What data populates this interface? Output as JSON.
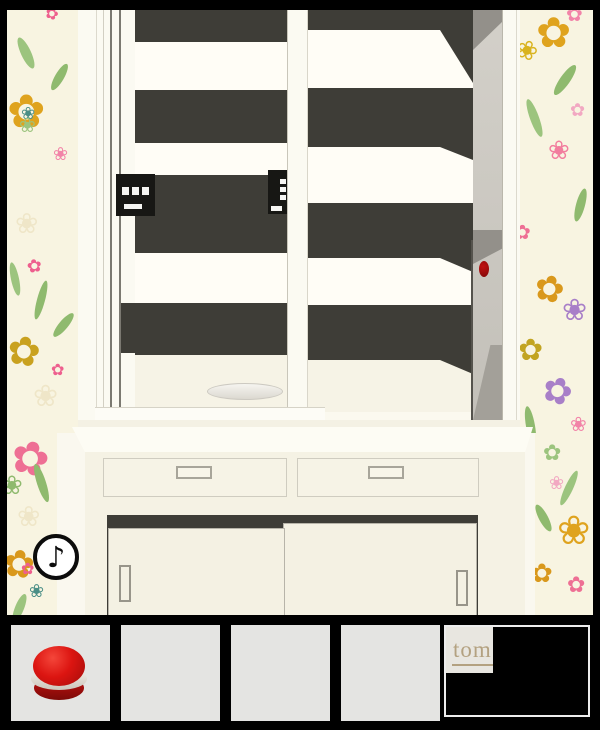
{
  "hud": {
    "music_button": {
      "icon": "music-note-icon",
      "glyph": "♪"
    }
  },
  "inventory": {
    "slots": [
      {
        "name": "slot-1",
        "item": "red-macaron"
      },
      {
        "name": "slot-2",
        "item": null
      },
      {
        "name": "slot-3",
        "item": null
      },
      {
        "name": "slot-4",
        "item": null
      },
      {
        "name": "slot-5",
        "item": "tomatea-logo",
        "label": "tom"
      }
    ]
  },
  "scene": {
    "shelf_items": [
      {
        "name": "black-box-front",
        "marks": "three-white-squares-and-bar"
      },
      {
        "name": "black-box-side",
        "marks": "three-white-squares-and-bar"
      }
    ],
    "red_button_on_side_panel": true,
    "plate_on_shelf": true,
    "drawers": 2,
    "sliding_doors": 2
  },
  "colors": {
    "frame_black": "#000000",
    "wall": "#faf8ef",
    "wallpaper_bg": "#f8f4e1",
    "cabinet_white": "#fbfaf2",
    "cabinet_cream": "#f5f2e4",
    "interior_dark": "#3e3d37",
    "side_panel": "#cbc8c1",
    "red_button": "#9c0c0c",
    "macaron_red": "#d91410",
    "macaron_cream": "#e9e4dc",
    "slot_gray": "#e4e4e2",
    "tom_text": "#b3a180"
  },
  "decor": {
    "panels": [
      {
        "container": "wp-left",
        "flowers": [
          {
            "x": 38,
            "y": -4,
            "s": 16,
            "c": "#ee5f8e",
            "g": "✿",
            "r": 20
          },
          {
            "x": 0,
            "y": 78,
            "s": 46,
            "c": "#dfa31e",
            "g": "✿",
            "r": 0
          },
          {
            "x": 14,
            "y": 96,
            "s": 17,
            "c": "#4a8e86",
            "g": "❀",
            "r": 0
          },
          {
            "x": 46,
            "y": 136,
            "s": 18,
            "c": "#f283a8",
            "g": "❀",
            "r": 0
          },
          {
            "x": 8,
            "y": 200,
            "s": 28,
            "c": "#efe6c8",
            "g": "❀",
            "r": 0
          },
          {
            "x": 20,
            "y": 248,
            "s": 18,
            "c": "#ee5f8e",
            "g": "✿",
            "r": -10
          },
          {
            "x": 0,
            "y": 322,
            "s": 40,
            "c": "#c9a11f",
            "g": "✿",
            "r": 10
          },
          {
            "x": 26,
            "y": 372,
            "s": 30,
            "c": "#efe6c8",
            "g": "❀",
            "r": 0
          },
          {
            "x": 44,
            "y": 352,
            "s": 16,
            "c": "#ee5f8e",
            "g": "✿",
            "r": 0
          },
          {
            "x": 12,
            "y": 105,
            "s": 20,
            "c": "#9cc47e",
            "g": "❀",
            "r": 0
          }
        ],
        "leaves": [
          {
            "x": 14,
            "y": 26,
            "w": 10,
            "h": 34,
            "rot": -25,
            "c": "#9cc47e"
          },
          {
            "x": 48,
            "y": 52,
            "w": 9,
            "h": 30,
            "rot": 30,
            "c": "#8fba6e"
          },
          {
            "x": 30,
            "y": 270,
            "w": 8,
            "h": 40,
            "rot": 15,
            "c": "#8fba6e"
          },
          {
            "x": 4,
            "y": 252,
            "w": 8,
            "h": 34,
            "rot": -12,
            "c": "#9cc47e"
          },
          {
            "x": 52,
            "y": 300,
            "w": 9,
            "h": 30,
            "rot": 40,
            "c": "#8fba6e"
          }
        ]
      },
      {
        "container": "wp-left2",
        "flowers": [
          {
            "x": 4,
            "y": 2,
            "s": 46,
            "c": "#ee6f94",
            "g": "✿",
            "r": 15
          },
          {
            "x": -6,
            "y": 40,
            "s": 26,
            "c": "#8fba6e",
            "g": "❀",
            "r": 0
          },
          {
            "x": 10,
            "y": 70,
            "s": 28,
            "c": "#efe6c8",
            "g": "❀",
            "r": 0
          },
          {
            "x": -4,
            "y": 112,
            "s": 38,
            "c": "#d9981c",
            "g": "✿",
            "r": 8
          },
          {
            "x": 22,
            "y": 150,
            "s": 18,
            "c": "#4a8e86",
            "g": "❀",
            "r": 0
          },
          {
            "x": 14,
            "y": 128,
            "s": 16,
            "c": "#ee5f8e",
            "g": "✿",
            "r": 0
          }
        ],
        "leaves": [
          {
            "x": 30,
            "y": 30,
            "w": 9,
            "h": 40,
            "rot": -18,
            "c": "#8fba6e"
          },
          {
            "x": 8,
            "y": 160,
            "w": 9,
            "h": 30,
            "rot": 22,
            "c": "#9cc47e"
          }
        ]
      },
      {
        "container": "wp-right",
        "flowers": [
          {
            "x": 16,
            "y": 2,
            "s": 42,
            "c": "#dfa31e",
            "g": "✿",
            "r": 0
          },
          {
            "x": -4,
            "y": 28,
            "s": 26,
            "c": "#d9b31e",
            "g": "❀",
            "r": 20
          },
          {
            "x": 46,
            "y": -6,
            "s": 20,
            "c": "#f283a8",
            "g": "✿",
            "r": 0
          },
          {
            "x": 28,
            "y": 128,
            "s": 26,
            "c": "#f27d9e",
            "g": "❀",
            "r": 0
          },
          {
            "x": 50,
            "y": 92,
            "s": 18,
            "c": "#f2a8c2",
            "g": "✿",
            "r": 0
          },
          {
            "x": -6,
            "y": 212,
            "s": 20,
            "c": "#ee6f94",
            "g": "✿",
            "r": 0
          },
          {
            "x": 14,
            "y": 262,
            "s": 36,
            "c": "#d9981c",
            "g": "✿",
            "r": 15
          },
          {
            "x": 42,
            "y": 286,
            "s": 30,
            "c": "#a87fc8",
            "g": "❀",
            "r": 0
          },
          {
            "x": -2,
            "y": 326,
            "s": 30,
            "c": "#c2a421",
            "g": "✿",
            "r": 0
          },
          {
            "x": 22,
            "y": 364,
            "s": 36,
            "c": "#a87fc8",
            "g": "✿",
            "r": 20
          },
          {
            "x": 50,
            "y": 404,
            "s": 20,
            "c": "#f283a8",
            "g": "❀",
            "r": 0
          }
        ],
        "leaves": [
          {
            "x": 40,
            "y": 52,
            "w": 10,
            "h": 36,
            "rot": 35,
            "c": "#8fba6e"
          },
          {
            "x": 10,
            "y": 88,
            "w": 9,
            "h": 40,
            "rot": -20,
            "c": "#9cc47e"
          },
          {
            "x": 56,
            "y": 178,
            "w": 9,
            "h": 34,
            "rot": 15,
            "c": "#8fba6e"
          },
          {
            "x": 6,
            "y": 396,
            "w": 9,
            "h": 40,
            "rot": -10,
            "c": "#8fba6e"
          }
        ]
      },
      {
        "container": "wp-right2",
        "flowers": [
          {
            "x": 8,
            "y": 10,
            "s": 22,
            "c": "#9cc47e",
            "g": "✿",
            "r": 0
          },
          {
            "x": 22,
            "y": 78,
            "s": 40,
            "c": "#dfa31e",
            "g": "❀",
            "r": 0
          },
          {
            "x": -4,
            "y": 128,
            "s": 26,
            "c": "#d9981c",
            "g": "✿",
            "r": 0
          },
          {
            "x": 32,
            "y": 142,
            "s": 22,
            "c": "#ee6f94",
            "g": "✿",
            "r": 0
          },
          {
            "x": 14,
            "y": 42,
            "s": 18,
            "c": "#f2a8c2",
            "g": "❀",
            "r": 0
          }
        ],
        "leaves": [
          {
            "x": 30,
            "y": 36,
            "w": 8,
            "h": 38,
            "rot": 25,
            "c": "#9cc47e"
          },
          {
            "x": 4,
            "y": 70,
            "w": 9,
            "h": 30,
            "rot": -28,
            "c": "#8fba6e"
          }
        ]
      }
    ]
  }
}
